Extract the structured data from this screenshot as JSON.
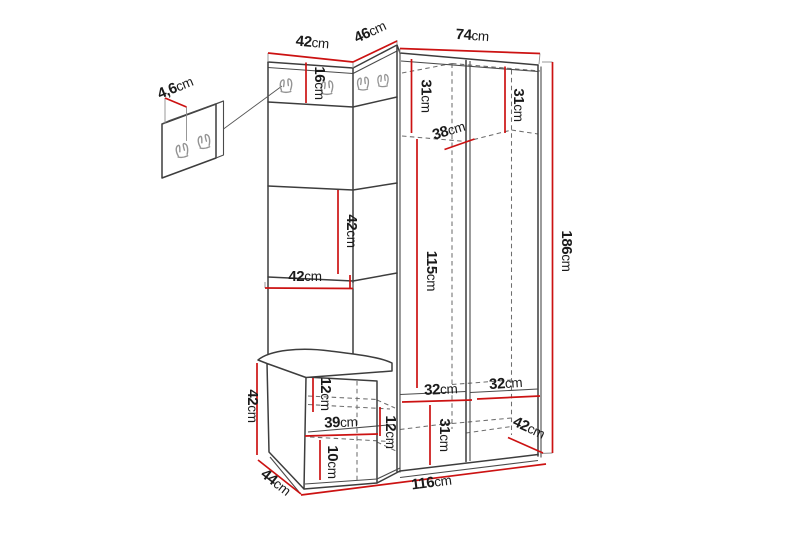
{
  "diagram": {
    "subject": "Hallway furniture set dimension drawing: corner wardrobe with hook panels, mirror panel, bench and separate wall hook panel",
    "background": "#ffffff",
    "colors": {
      "outline": "#3d3d3d",
      "hidden_edge": "#6e6e6e",
      "dimension_line": "#cc1212",
      "label_text": "#1b1b1b",
      "hook": "#949494"
    },
    "hooks": {
      "style": "double-prong wall hook",
      "count_main_unit": 4,
      "count_wall_panel": 2
    },
    "dimensions": {
      "top_left_width": {
        "value": "42",
        "unit": "cm"
      },
      "top_corner_width": {
        "value": "46",
        "unit": "cm"
      },
      "top_right_width": {
        "value": "74",
        "unit": "cm"
      },
      "hook_strip_height": {
        "value": "16",
        "unit": "cm"
      },
      "wall_panel_thickness": {
        "value": "4,6",
        "unit": "cm"
      },
      "upper_left_compartment_height": {
        "value": "31",
        "unit": "cm"
      },
      "upper_right_compartment_height": {
        "value": "31",
        "unit": "cm"
      },
      "upper_shelf_depth": {
        "value": "38",
        "unit": "cm"
      },
      "mirror_height": {
        "value": "42",
        "unit": "cm"
      },
      "mirror_width": {
        "value": "42",
        "unit": "cm"
      },
      "hanging_space_height": {
        "value": "115",
        "unit": "cm"
      },
      "total_height": {
        "value": "186",
        "unit": "cm"
      },
      "bench_height": {
        "value": "42",
        "unit": "cm"
      },
      "bench_top_inset": {
        "value": "12",
        "unit": "cm"
      },
      "bench_inner_width": {
        "value": "39",
        "unit": "cm"
      },
      "bench_right_inset": {
        "value": "12",
        "unit": "cm"
      },
      "bench_bottom_inset": {
        "value": "10",
        "unit": "cm"
      },
      "bench_depth": {
        "value": "44",
        "unit": "cm"
      },
      "lower_left_compartment_width": {
        "value": "32",
        "unit": "cm"
      },
      "lower_right_compartment_width": {
        "value": "32",
        "unit": "cm"
      },
      "lower_compartment_height": {
        "value": "31",
        "unit": "cm"
      },
      "wardrobe_depth": {
        "value": "42",
        "unit": "cm"
      },
      "total_width": {
        "value": "116",
        "unit": "cm"
      }
    }
  }
}
